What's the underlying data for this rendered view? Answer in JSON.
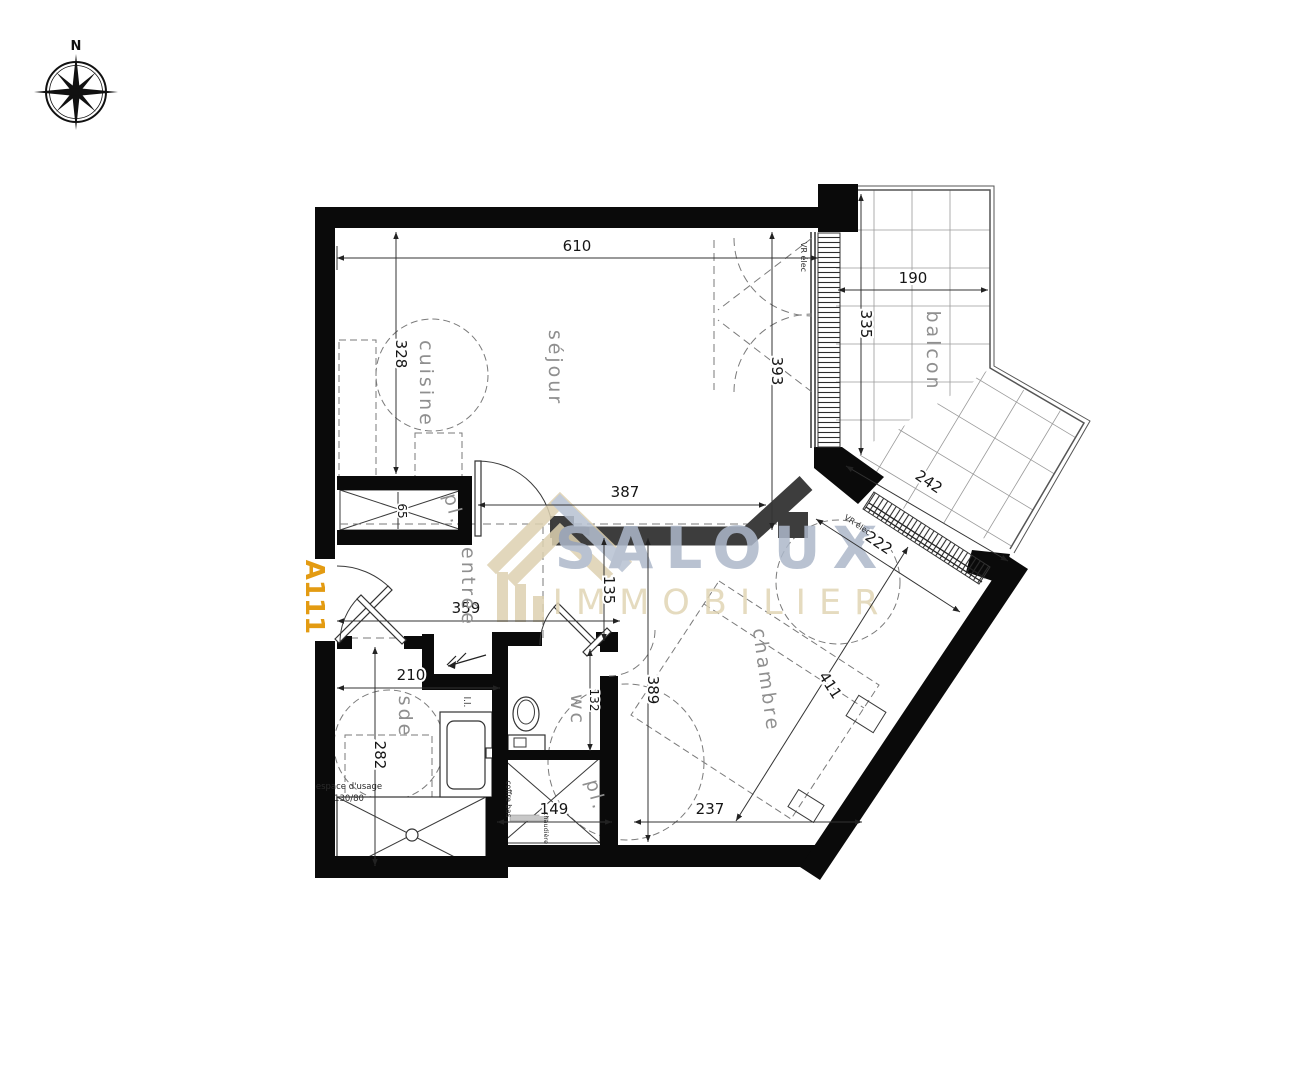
{
  "unit": {
    "label": "A111",
    "label_color": "#e39b12"
  },
  "compass": {
    "north": "N"
  },
  "watermark": {
    "brand": "SALOUX",
    "subbrand": "IMMOBILIER",
    "brand_color": "#adb8ca",
    "subbrand_color": "#e1d5b5",
    "icon": "house-roof-icon"
  },
  "rooms": {
    "sejour": "séjour",
    "cuisine": "cuisine",
    "entree": "entrée",
    "chambre": "chambre",
    "sde": "sde",
    "wc": "wc",
    "balcon": "balcon",
    "placard_haut": "pl.",
    "placard_bas": "pl."
  },
  "dims": {
    "d610": "610",
    "d328": "328",
    "d393": "393",
    "d190": "190",
    "d335": "335",
    "d242": "242",
    "d222": "222",
    "d387": "387",
    "d135": "135",
    "d359": "359",
    "d65": "65",
    "d210": "210",
    "d282": "282",
    "d132": "132",
    "d389": "389",
    "d411": "411",
    "d237": "237",
    "d149": "149"
  },
  "notes": {
    "vr_elec_sejour": "VR élec",
    "vr_elec_chambre": "VR élec",
    "espace_usage": "espace d'usage",
    "espace_usage_dims": "130/80",
    "lave_linge": "l.l.",
    "coffre_bas": "coffre bas",
    "chaudiere": "chaudière"
  },
  "colors": {
    "wall": "#0a0a0a",
    "inner_wall": "#3d3d3d"
  }
}
